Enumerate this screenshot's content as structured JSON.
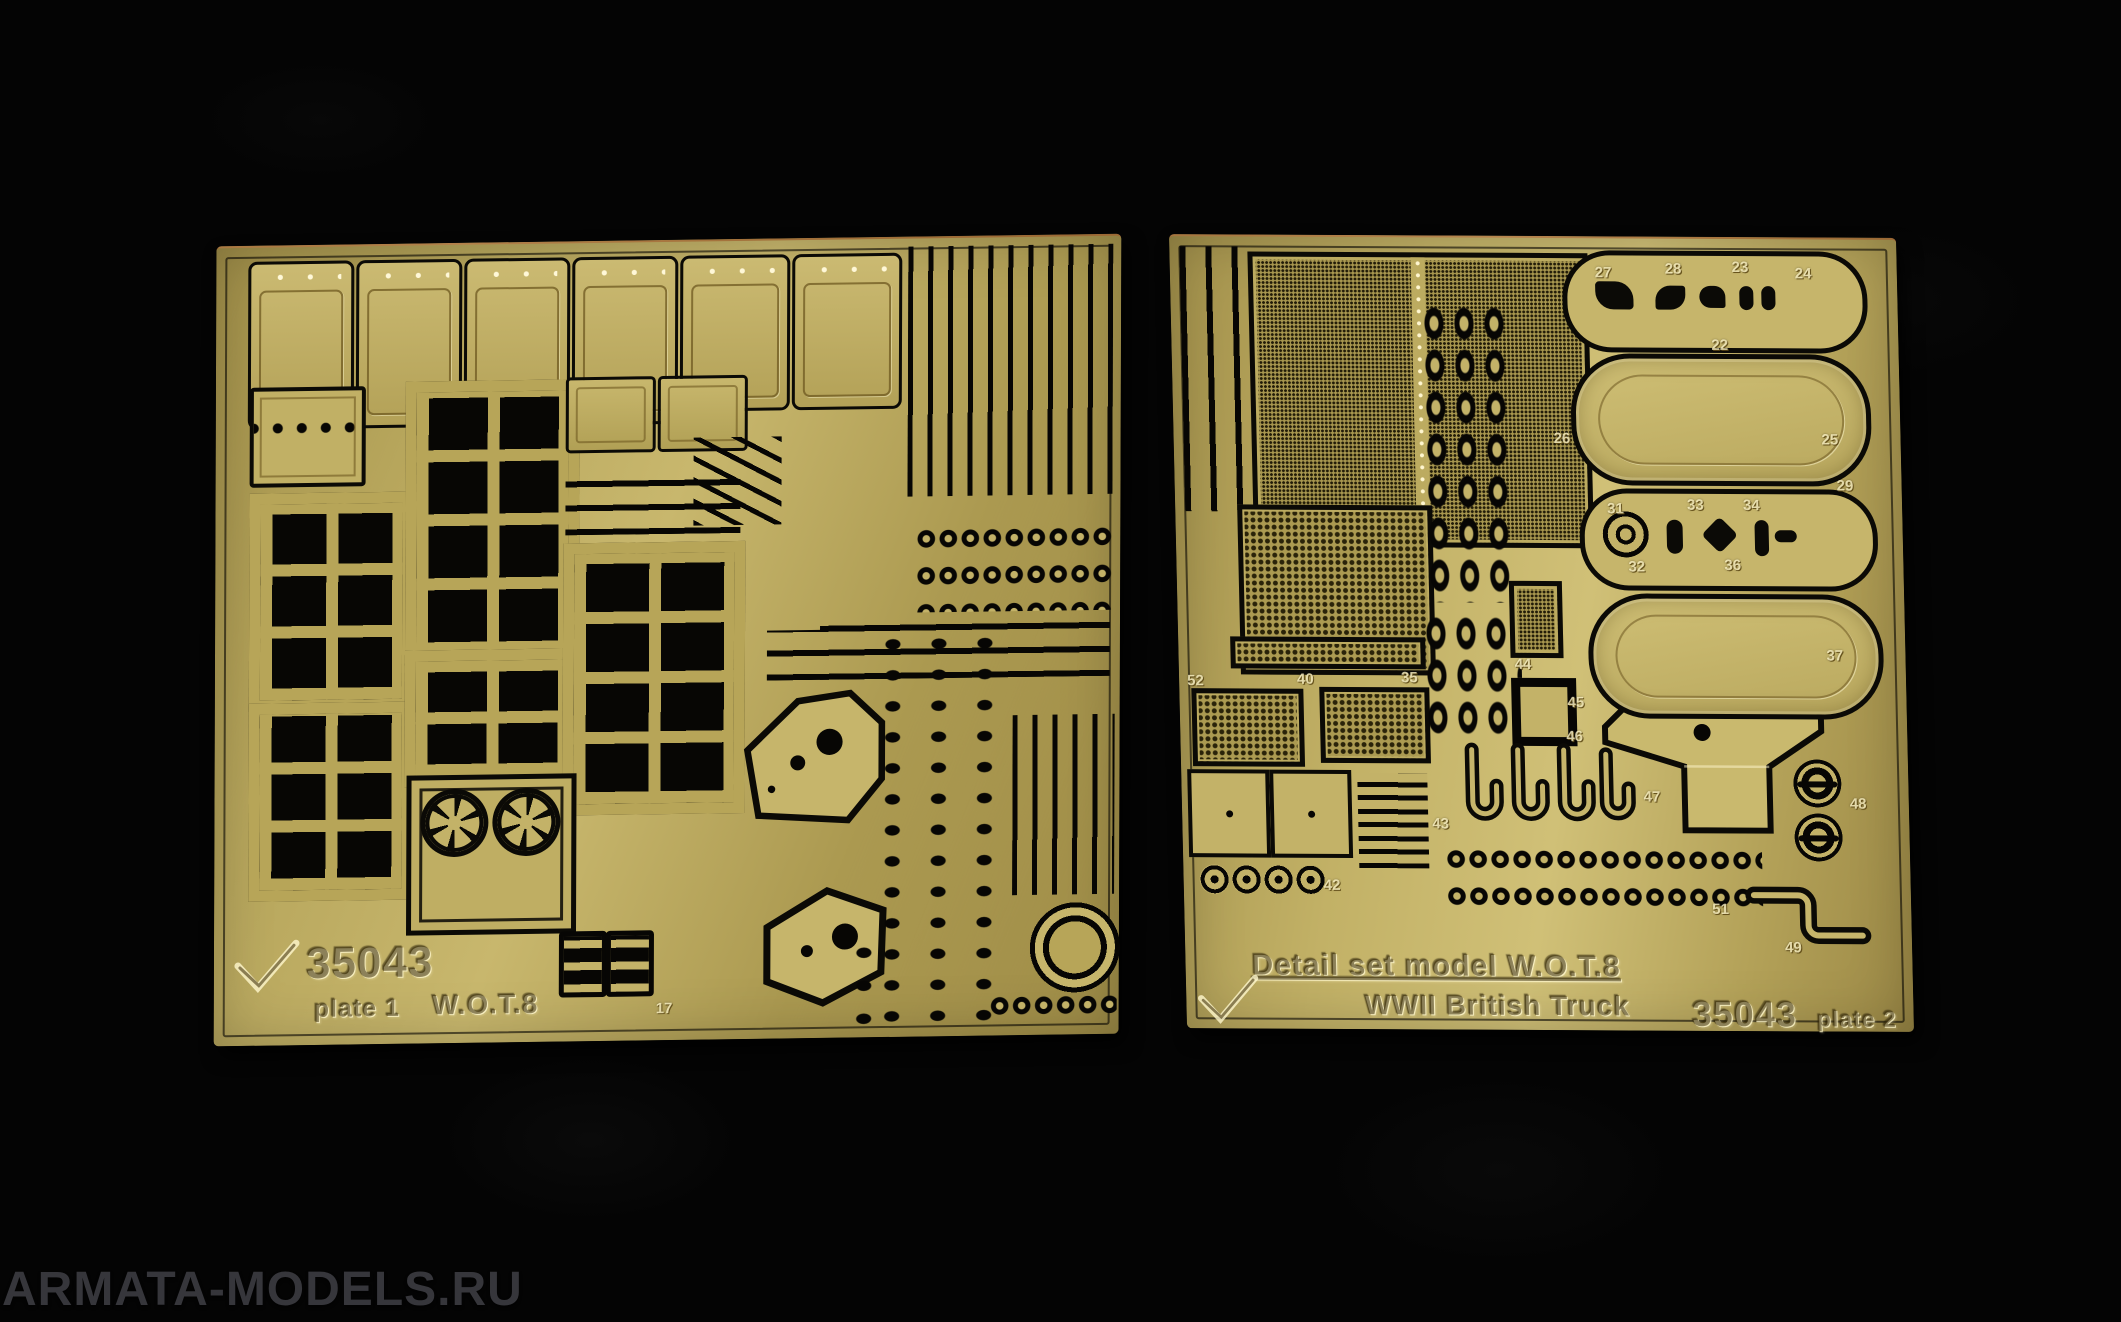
{
  "watermark": "ARMATA-MODELS.RU",
  "colors": {
    "background": "#040404",
    "brass_left": "#b2a053",
    "brass_right": "#bcab63",
    "cutout": "#070604",
    "watermark_text": "#36363b"
  },
  "brand": {
    "logo_icon": "ace-checkmark-icon"
  },
  "left_plate": {
    "code": "35043",
    "plate_label": "plate 1",
    "model_label": "W.O.T.8",
    "num17": "17"
  },
  "right_plate": {
    "title1": "Detail set model W.O.T.8",
    "title2": "WWII British Truck",
    "code": "35043",
    "plate_label": "plate 2",
    "nums": {
      "22": "22",
      "23": "23",
      "24": "24",
      "25": "25",
      "26": "26",
      "27": "27",
      "28": "28",
      "29": "29",
      "31": "31",
      "32": "32",
      "33": "33",
      "34": "34",
      "35": "35",
      "36": "36",
      "37": "37",
      "40": "40",
      "42": "42",
      "43": "43",
      "44": "44",
      "45": "45",
      "46": "46",
      "47": "47",
      "48": "48",
      "49": "49",
      "51": "51",
      "52": "52"
    }
  }
}
